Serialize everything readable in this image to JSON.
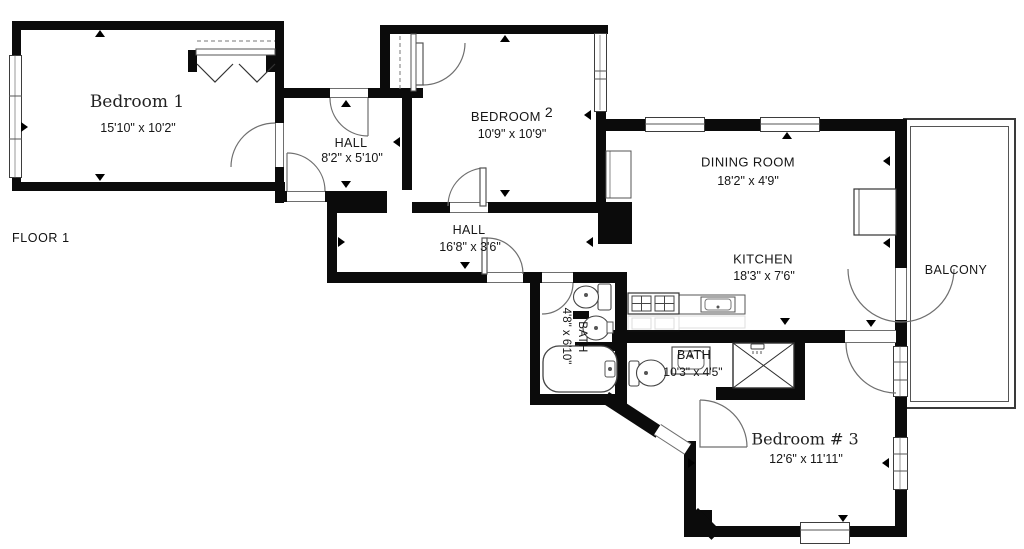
{
  "floor": {
    "label": "FLOOR 1"
  },
  "rooms": {
    "bedroom1": {
      "name": "Bedroom 1",
      "dims": "15'10\" x 10'2\""
    },
    "hall1": {
      "name": "HALL",
      "dims": "8'2\" x 5'10\""
    },
    "bedroom2": {
      "name": "BEDROOM",
      "number": "2",
      "dims": "10'9\" x 10'9\""
    },
    "dining_room": {
      "name": "DINING ROOM",
      "dims": "18'2\" x 4'9\""
    },
    "kitchen": {
      "name": "KITCHEN",
      "dims": "18'3\" x 7'6\""
    },
    "hall2": {
      "name": "HALL",
      "dims": "16'8\" x 3'6\""
    },
    "bath1": {
      "name": "BATH",
      "dims": "4'8\" x 6'10\""
    },
    "bath2": {
      "name": "BATH",
      "dims": "10'3\" x 4'5\""
    },
    "bedroom3": {
      "name": "Bedroom # 3",
      "dims": "12'6\" x 11'11\""
    },
    "balcony": {
      "name": "BALCONY"
    }
  },
  "colors": {
    "wall": "#0b0b0b",
    "fixture_line": "#555555",
    "text": "#1a1a1a"
  }
}
